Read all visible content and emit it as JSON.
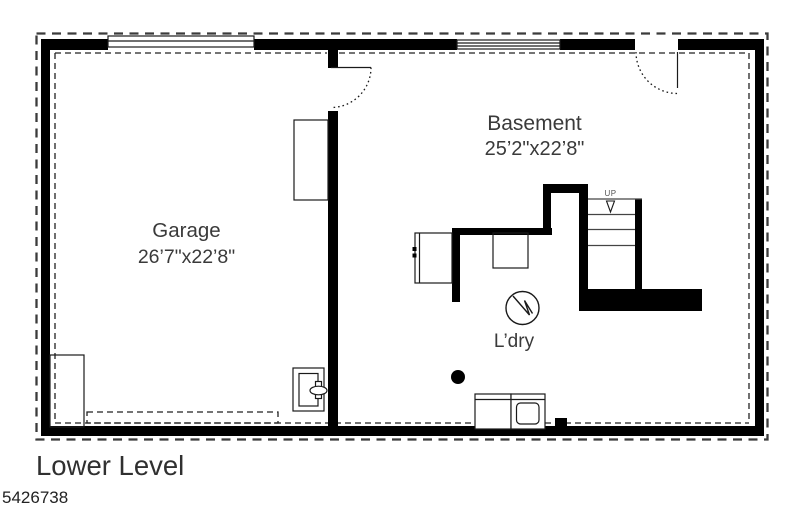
{
  "plan": {
    "rooms": {
      "garage": {
        "name": "Garage",
        "dimensions": "26’7\"x22’8\""
      },
      "basement": {
        "name": "Basement",
        "dimensions": "25’2\"x22’8\""
      }
    },
    "laundry_label": "L’dry",
    "stairs": {
      "direction_label": "UP"
    }
  },
  "footer": {
    "level_title": "Lower Level",
    "plan_number": "5426738"
  },
  "icons": {
    "laundry_symbol": "circle-zigzag",
    "stairs_arrow": "open-triangle-down",
    "column": "filled-dot"
  },
  "colors": {
    "wall": "#000000",
    "line": "#1a1a1a",
    "dashed_outline": "#3b3b3b",
    "text": "#3a3a3a",
    "paper": "#ffffff"
  }
}
